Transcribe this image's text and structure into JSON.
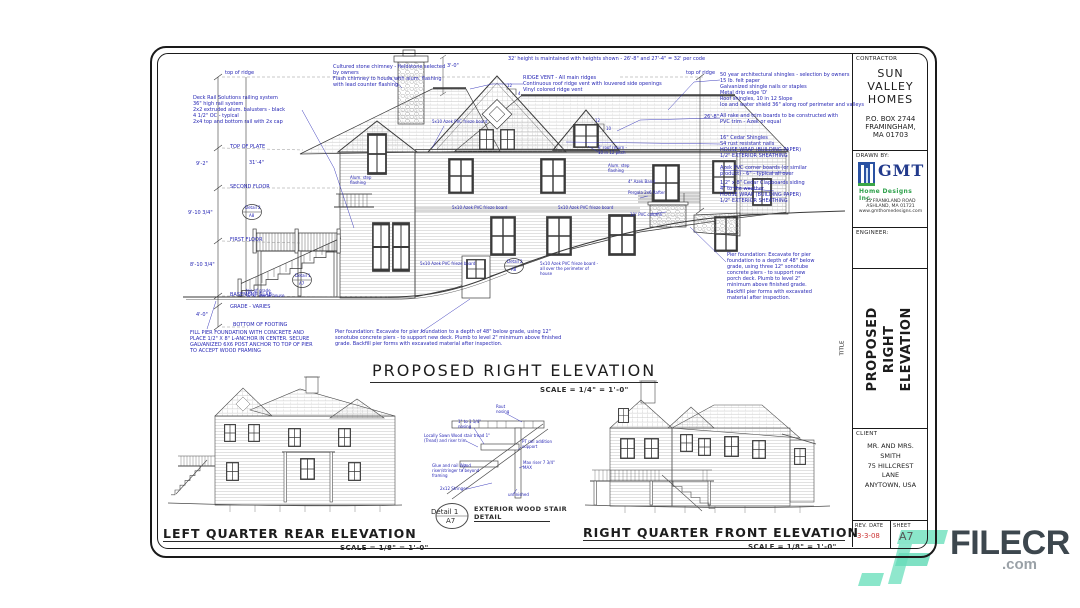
{
  "titles": {
    "main": "PROPOSED RIGHT ELEVATION",
    "main_scale": "SCALE = 1/4\" = 1'-0\"",
    "left_rear": "LEFT QUARTER REAR ELEVATION",
    "left_rear_scale": "SCALE = 1/8\" = 1'-0\"",
    "right_front": "RIGHT QUARTER FRONT ELEVATION",
    "right_front_scale": "SCALE = 1/8\" = 1'-0\"",
    "detail_name": "Detail 1",
    "detail_sheet": "A7",
    "detail_title": "EXTERIOR WOOD STAIR\nDETAIL"
  },
  "title_block": {
    "contractor_label": "CONTRACTOR",
    "contractor_name": "SUN\nVALLEY\nHOMES",
    "contractor_address": "P.O. BOX 2744\nFRAMINGHAM,\nMA 01703",
    "drawn_by_label": "DRAWN BY:",
    "logo_text": "GMT",
    "logo_subtext": "Home Designs Inc.",
    "logo_address": "35 FRANKLAND ROAD\nASHLAND, MA 01721\nwww.gmthomedesigns.com",
    "engineer_label": "ENGINEER:",
    "title_label": "TITLE",
    "title_text": "PROPOSED RIGHT\nELEVATION",
    "client_label": "CLIENT",
    "client_text": "MR. AND MRS.\nSMITH\n75 HILLCREST\nLANE\nANYTOWN, USA",
    "rev_date_label": "REV. DATE",
    "rev_date_value": "3-3-08",
    "sheet_label": "SHEET",
    "sheet_value": "A7"
  },
  "dims": {
    "top_of_ridge_left": "top of ridge",
    "top_of_ridge_right": "top of ridge",
    "top_of_plate": "TOP OF PLATE",
    "dim_9_2": "9'-2\"",
    "second_floor": "SECOND FLOOR",
    "dim_9_10": "9'-10 3/4\"",
    "first_floor": "FIRST FLOOR",
    "dim_8_10": "8'-10 3/4\"",
    "basement_slab": "BASEMENT SLAB",
    "grade_varies": "GRADE - VARIES",
    "dim_4_0": "4'-0\"",
    "bottom_of_footing": "BOTTOM OF FOOTING",
    "dim_31_4": "31'-4\"",
    "dim_26_8": "26'-8\"",
    "dim_3_0": "3'-0\"",
    "pitch_12": "12",
    "pitch_4": "4",
    "pitch_10": "10",
    "top_of_grade": "top of grade\n12'-0\" below house"
  },
  "notes": {
    "deck_rail": "Deck Rail Solutions railing system\n36\" high rail system\n2x2 extruded alum. balusters - black\n4 1/2\" OC - typical\n2x4 top and bottom rail with 2x cap",
    "chimney": "Cultured stone chimney - fieldstone selected\nby owners\nFlash chimney to house with alum. flashing\nwith lead counter flashing",
    "height_code": "32' height is maintained with heights shown - 26'-8\" and 27'-4\" = 32' per code",
    "ridge_vent": "RIDGE VENT - All main ridges\nContinuous roof ridge vent with louvered side openings\nVinyl colored ridge vent",
    "shingles": "50 year architectural shingles - selection by owners\n15 lb. felt paper\nGalvanized shingle nails or staples\nMetal drip edge 'D'\nRoof shingles, 10 in 12 Slope\nIce and water shield 36\" along roof perimeter and valleys",
    "rake": "All rake and trim boards to be constructed with\nPVC trim - Azek or equal",
    "cedar_shingles": "16\" Cedar Shingles\nS4 rust resistant nails\nHOUSE WRAP (BUILDING PAPER)\n1/2\" EXTERIOR SHEATHING",
    "corner_boards": "Azek PVC corner boards (or similar\nproduct) - 6\" - typical all over",
    "clapboards": "1/2\" x 8\" Cedar Clapboards siding\n4\" to the weather\nHOUSE WRAP (BUILDING PAPER)\n1/2\" EXTERIOR SHEATHING",
    "pier_right": "Pier foundation: Excavate for pier\nfoundation to a depth of 48\" below\ngrade, using three 12\" sonotube\nconcrete piers - to support new\nporch deck. Plumb to level 2\"\nminimum above finished grade.\nBackfill pier forms with excavated\nmaterial after inspection.",
    "fill_pier": "FILL PIER FOUNDATION WITH CONCRETE AND\nPLACE 1/2\" X 8\" L-ANCHOR IN CENTER. SECURE\nGALVANIZED 6X6 POST ANCHOR TO TOP OF PIER\nTO ACCEPT WOOD FRAMING",
    "pier_bottom": "Pier foundation: Excavate for pier foundation to a depth of 48\" below grade, using 12\"\nsonotube concrete piers - to support new deck. Plumb to level 2\" minimum above finished\ngrade. Backfill pier forms with excavated material after inspection."
  },
  "labels": {
    "frieze": "5x10 Azek PVC frieze board",
    "frieze_perimeter": "5x10 Azek PVC frieze board -\nall over the perimeter of\nhouse",
    "step_flashing": "Alum. step\nflashing",
    "roof_return": "8' roof return -\n10 in 12 pitch",
    "pergola": "Pergola 2x6 Rafter",
    "pvc_column": "10\" PVC column",
    "azek_band": "4\" Azek Band",
    "detail1_ref": "Detail 1",
    "detail1_sheet": "A7",
    "detail2_ref": "Detail 2",
    "detail2_sheet": "A8"
  },
  "stair_notes": {
    "rout": "Rout\nnosing",
    "nosing": "1\" to 1 1/4\"\nnosing",
    "tread": "Locally Sawn Wood stair tread 1\"\n(Tread) and riser trim",
    "glue": "Glue and nail Wood\nriser/stringer to beyond\nframing",
    "stringer": "2x12 Stringer",
    "rail_support": "PT rail addition\nsupport",
    "riser": "Max riser 7 3/4\"\nMAX",
    "unfinished": "unfinished"
  },
  "watermark": {
    "brand": "FILECR",
    "tld": ".com",
    "color": "#7de3c4"
  }
}
